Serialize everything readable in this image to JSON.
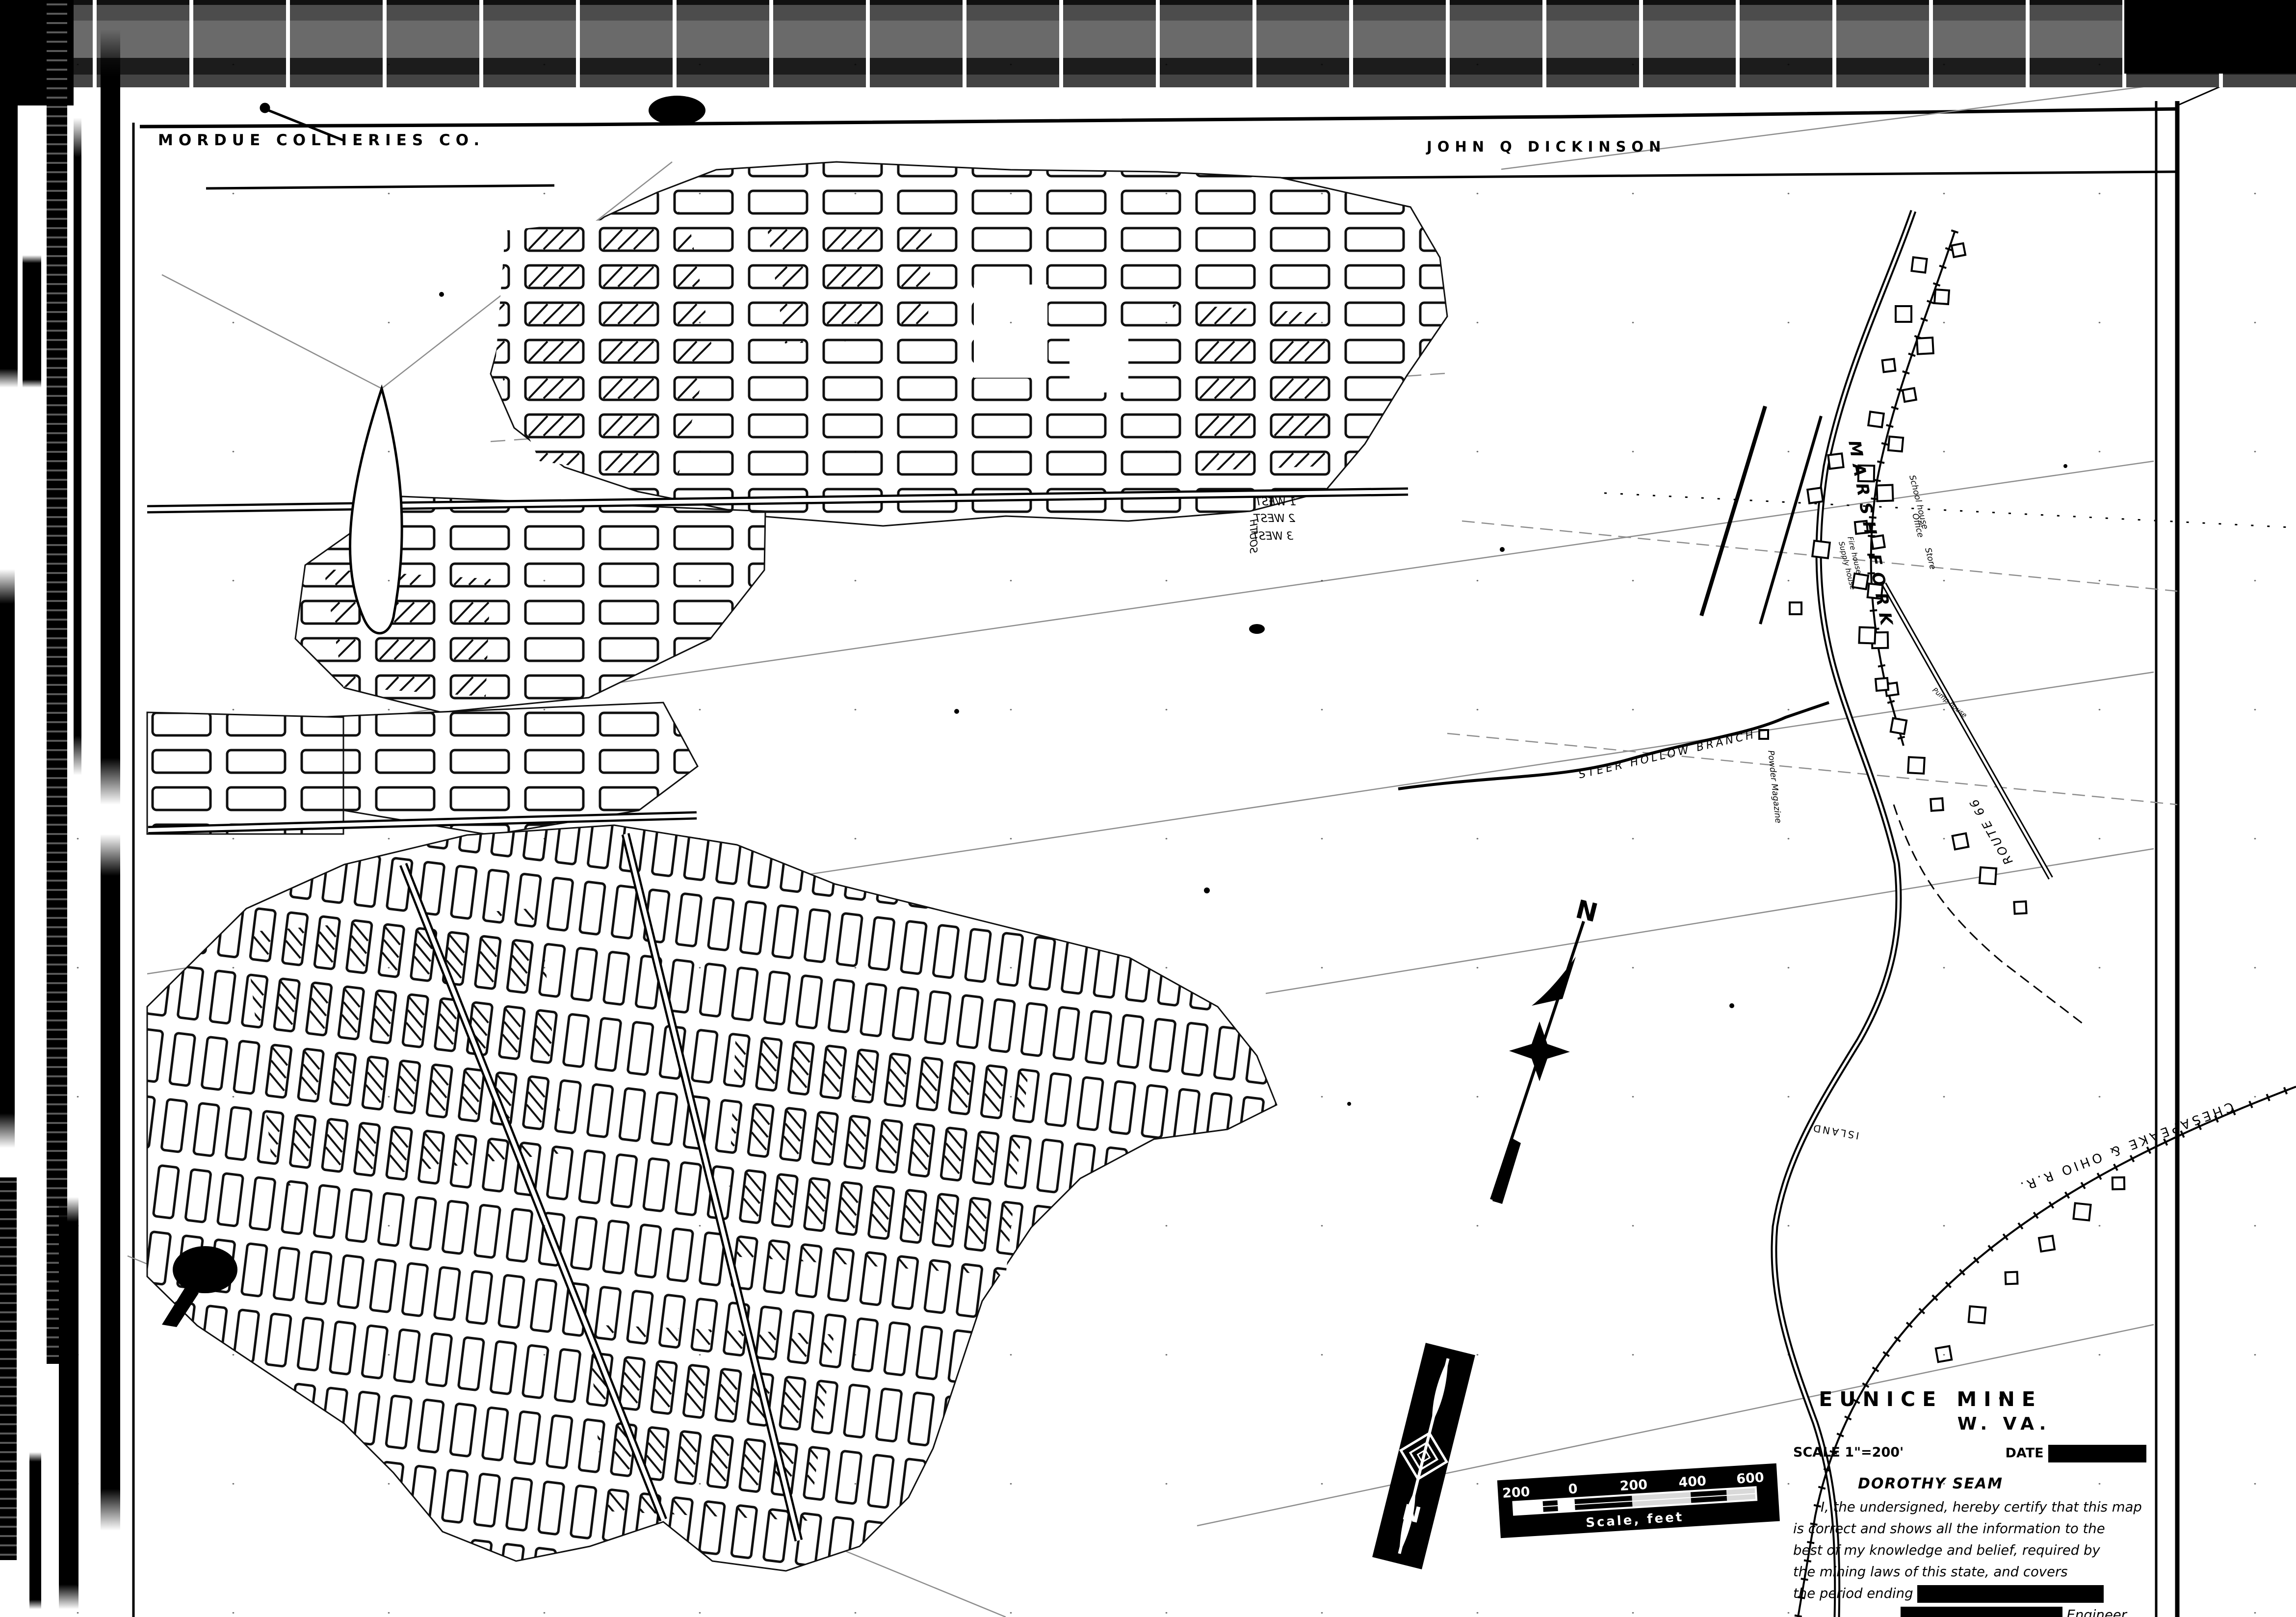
{
  "header": {
    "company": "MORDUE COLLIERIES CO.",
    "owner": "JOHN Q DICKINSON"
  },
  "map_labels": {
    "creek": "MARSH FORK",
    "branch": "STEER HOLLOW BRANCH",
    "railroad": "CHESAPEAKE & OHIO R.R.",
    "island": "ISLAND",
    "route": "ROUTE 66",
    "powder_magazine": "Powder Magazine",
    "school_house": "School house",
    "office": "Office",
    "store": "Store",
    "fire_house": "Fire house",
    "supply_house": "Supply house",
    "pump_house": "Pump house",
    "entries": [
      "1 WEST",
      "2 WEST",
      "3 WEST",
      "SOUTH"
    ]
  },
  "north_arrow": {
    "label": "N"
  },
  "compass_stamp": {
    "label": "N"
  },
  "scale_bar": {
    "ticks": [
      "200",
      "0",
      "200",
      "400",
      "600"
    ],
    "caption": "Scale, feet"
  },
  "title_block": {
    "title_line1": "EUNICE MINE",
    "title_line2": "W. VA.",
    "scale_label": "SCALE 1\"=200'",
    "date_label": "DATE",
    "seam": "DOROTHY SEAM",
    "cert_line1": "I, the undersigned, hereby certify that this map",
    "cert_line2": "is correct and shows all the information to the",
    "cert_line3": "best of my knowledge and belief, required by",
    "cert_line4": "the mining laws of this state, and covers",
    "cert_line5": "the period ending",
    "engineer_label": "Engineer.",
    "ack_line": "Acknowledged before me, a",
    "this_label": "this",
    "day_of_label": "day of"
  },
  "colors": {
    "ink": "#000000",
    "paper": "#ffffff",
    "faint_line": "#8d8d8d"
  }
}
